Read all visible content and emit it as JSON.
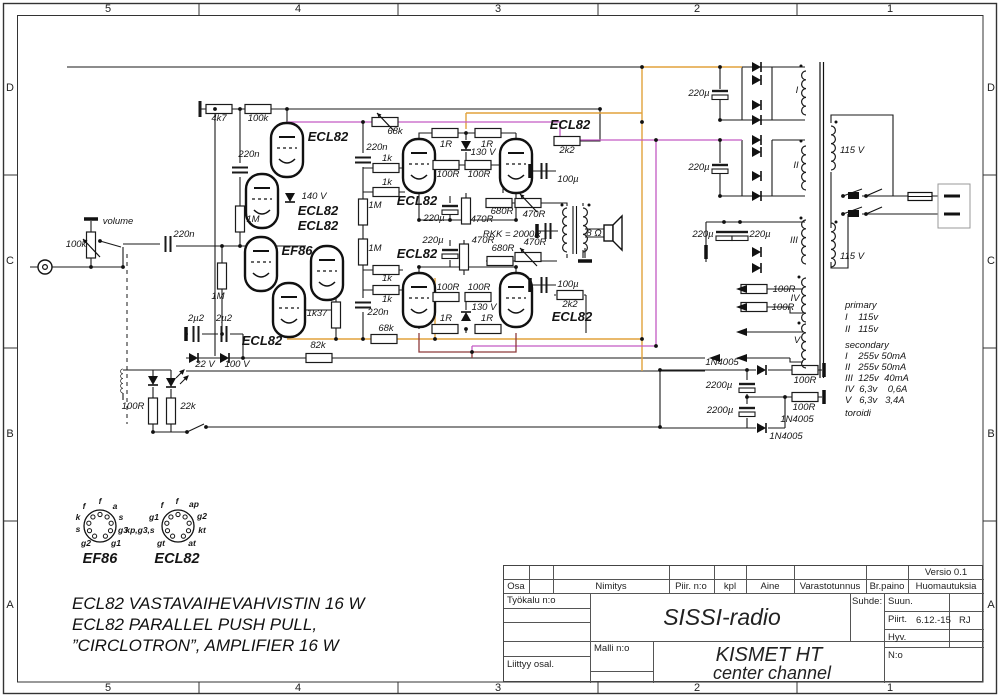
{
  "frame": {
    "cols": [
      "5",
      "4",
      "3",
      "2",
      "1"
    ],
    "rows": [
      "D",
      "C",
      "B",
      "A"
    ]
  },
  "colors": {
    "wire": "#1a1a1a",
    "orange": "#e2a23b",
    "magenta": "#c45ac4",
    "maroon": "#8e3b3b"
  },
  "notes": {
    "line1": "ECL82 VASTAVAIHEVAHVISTIN 16 W",
    "line2": "ECL82 PARALLEL PUSH PULL,",
    "line3": "”CIRCLOTRON”, AMPLIFIER 16 W"
  },
  "titleblock": {
    "versio": "Versio 0.1",
    "osa": "Osa",
    "nimitys": "Nimitys",
    "piir_no": "Piir. n:o",
    "kpl": "kpl",
    "aine": "Aine",
    "varastotunnus": "Varastotunnus",
    "brpaino": "Br.paino",
    "huomautuksia": "Huomautuksia",
    "tyokalu": "Työkalu n:o",
    "liittyy": "Liittyy osal.",
    "malli": "Malli n:o",
    "suhde": "Suhde:",
    "suun": "Suun.",
    "piirt": "Piirt.",
    "piirt_date": "6.12.-15",
    "piirt_init": "RJ",
    "hyv": "Hyv.",
    "no_label": "N:o",
    "project": "SISSI-radio",
    "title1": "KISMET HT",
    "title2": "center channel"
  },
  "schematic": {
    "labels": [
      {
        "t": "4k7",
        "x": 219,
        "y": 121
      },
      {
        "t": "100k",
        "x": 258,
        "y": 121
      },
      {
        "t": "220n",
        "x": 249,
        "y": 157
      },
      {
        "t": "1M",
        "x": 253,
        "y": 222
      },
      {
        "t": "volume",
        "x": 118,
        "y": 224
      },
      {
        "t": "100k",
        "x": 76,
        "y": 247
      },
      {
        "t": "220n",
        "x": 184,
        "y": 237
      },
      {
        "t": "1M",
        "x": 218,
        "y": 299
      },
      {
        "t": "140 V",
        "x": 314,
        "y": 199
      },
      {
        "t": "ECL82",
        "x": 328,
        "y": 141,
        "c": "b"
      },
      {
        "t": "ECL82",
        "x": 318,
        "y": 215,
        "c": "b"
      },
      {
        "t": "ECL82",
        "x": 318,
        "y": 230,
        "c": "b"
      },
      {
        "t": "EF86",
        "x": 297,
        "y": 255,
        "c": "b"
      },
      {
        "t": "ECL82",
        "x": 262,
        "y": 345,
        "c": "b"
      },
      {
        "t": "1k37",
        "x": 317,
        "y": 316
      },
      {
        "t": "82k",
        "x": 318,
        "y": 348
      },
      {
        "t": "2µ2",
        "x": 196,
        "y": 321
      },
      {
        "t": "2µ2",
        "x": 224,
        "y": 321
      },
      {
        "t": "22 V",
        "x": 205,
        "y": 367
      },
      {
        "t": "100 V",
        "x": 237,
        "y": 367
      },
      {
        "t": "100R",
        "x": 133,
        "y": 409
      },
      {
        "t": "22k",
        "x": 188,
        "y": 409
      },
      {
        "t": "68k",
        "x": 395,
        "y": 134
      },
      {
        "t": "220n",
        "x": 377,
        "y": 150
      },
      {
        "t": "1k",
        "x": 387,
        "y": 161
      },
      {
        "t": "1k",
        "x": 387,
        "y": 185
      },
      {
        "t": "1M",
        "x": 375,
        "y": 208
      },
      {
        "t": "1M",
        "x": 375,
        "y": 251
      },
      {
        "t": "1k",
        "x": 387,
        "y": 281
      },
      {
        "t": "1k",
        "x": 387,
        "y": 302
      },
      {
        "t": "220n",
        "x": 378,
        "y": 315
      },
      {
        "t": "68k",
        "x": 386,
        "y": 331
      },
      {
        "t": "1R",
        "x": 446,
        "y": 147
      },
      {
        "t": "1R",
        "x": 487,
        "y": 147
      },
      {
        "t": "130 V",
        "x": 483,
        "y": 155
      },
      {
        "t": "100R",
        "x": 448,
        "y": 177
      },
      {
        "t": "100R",
        "x": 479,
        "y": 177
      },
      {
        "t": "ECL82",
        "x": 417,
        "y": 205,
        "c": "b"
      },
      {
        "t": "ECL82",
        "x": 417,
        "y": 258,
        "c": "b"
      },
      {
        "t": "220µ",
        "x": 434,
        "y": 221
      },
      {
        "t": "470R",
        "x": 482,
        "y": 222
      },
      {
        "t": "680R",
        "x": 502,
        "y": 214
      },
      {
        "t": "470R",
        "x": 534,
        "y": 217
      },
      {
        "t": "RKK = 2000R",
        "x": 512,
        "y": 237
      },
      {
        "t": "220µ",
        "x": 433,
        "y": 243
      },
      {
        "t": "470R",
        "x": 483,
        "y": 243
      },
      {
        "t": "680R",
        "x": 503,
        "y": 251
      },
      {
        "t": "470R",
        "x": 535,
        "y": 245
      },
      {
        "t": "100R",
        "x": 448,
        "y": 290
      },
      {
        "t": "100R",
        "x": 479,
        "y": 290
      },
      {
        "t": "130 V",
        "x": 484,
        "y": 310
      },
      {
        "t": "1R",
        "x": 446,
        "y": 321
      },
      {
        "t": "1R",
        "x": 487,
        "y": 321
      },
      {
        "t": "2k2",
        "x": 567,
        "y": 153
      },
      {
        "t": "ECL82",
        "x": 570,
        "y": 129,
        "c": "b"
      },
      {
        "t": "100µ",
        "x": 568,
        "y": 182
      },
      {
        "t": "8 Ω",
        "x": 594,
        "y": 236
      },
      {
        "t": "100µ",
        "x": 568,
        "y": 287
      },
      {
        "t": "2k2",
        "x": 570,
        "y": 307
      },
      {
        "t": "ECL82",
        "x": 572,
        "y": 321,
        "c": "b"
      },
      {
        "t": "220µ",
        "x": 699,
        "y": 96
      },
      {
        "t": "220µ",
        "x": 699,
        "y": 170
      },
      {
        "t": "I",
        "x": 797,
        "y": 93
      },
      {
        "t": "II",
        "x": 796,
        "y": 168
      },
      {
        "t": "III",
        "x": 794,
        "y": 243
      },
      {
        "t": "IV",
        "x": 795,
        "y": 301
      },
      {
        "t": "V",
        "x": 797,
        "y": 343
      },
      {
        "t": "115 V",
        "x": 852,
        "y": 153
      },
      {
        "t": "115 V",
        "x": 852,
        "y": 259
      },
      {
        "t": "220µ",
        "x": 703,
        "y": 237
      },
      {
        "t": "220µ",
        "x": 760,
        "y": 237
      },
      {
        "t": "100R",
        "x": 784,
        "y": 292
      },
      {
        "t": "100R",
        "x": 783,
        "y": 310
      },
      {
        "t": "1N4005",
        "x": 722,
        "y": 365
      },
      {
        "t": "2200µ",
        "x": 719,
        "y": 388
      },
      {
        "t": "2200µ",
        "x": 720,
        "y": 413
      },
      {
        "t": "100R",
        "x": 805,
        "y": 383
      },
      {
        "t": "100R",
        "x": 804,
        "y": 410
      },
      {
        "t": "1N4005",
        "x": 797,
        "y": 422
      },
      {
        "t": "1N4005",
        "x": 786,
        "y": 439
      },
      {
        "t": "primary",
        "x": 845,
        "y": 308,
        "c": "sp",
        "a": "s"
      },
      {
        "t": "I    115v",
        "x": 845,
        "y": 320,
        "c": "sp",
        "a": "s"
      },
      {
        "t": "II   115v",
        "x": 845,
        "y": 332,
        "c": "sp",
        "a": "s"
      },
      {
        "t": "secondary",
        "x": 845,
        "y": 348,
        "c": "sp",
        "a": "s"
      },
      {
        "t": "I    255v 50mA",
        "x": 845,
        "y": 359,
        "c": "sp",
        "a": "s"
      },
      {
        "t": "II   255v 50mA",
        "x": 845,
        "y": 370,
        "c": "sp",
        "a": "s"
      },
      {
        "t": "III  125v  40mA",
        "x": 845,
        "y": 381,
        "c": "sp",
        "a": "s"
      },
      {
        "t": "IV  6,3v    0,6A",
        "x": 845,
        "y": 392,
        "c": "sp",
        "a": "s"
      },
      {
        "t": "V   6,3v   3,4A",
        "x": 845,
        "y": 403,
        "c": "sp",
        "a": "s"
      },
      {
        "t": "toroidi",
        "x": 845,
        "y": 416,
        "c": "sp",
        "a": "s"
      },
      {
        "t": "f",
        "x": 100,
        "y": 504,
        "c": "pin"
      },
      {
        "t": "f",
        "x": 84,
        "y": 509,
        "c": "pin"
      },
      {
        "t": "a",
        "x": 115,
        "y": 509,
        "c": "pin"
      },
      {
        "t": "k",
        "x": 78,
        "y": 520,
        "c": "pin"
      },
      {
        "t": "s",
        "x": 121,
        "y": 520,
        "c": "pin"
      },
      {
        "t": "s",
        "x": 78,
        "y": 532,
        "c": "pin"
      },
      {
        "t": "g3",
        "x": 123,
        "y": 533,
        "c": "pin"
      },
      {
        "t": "g2",
        "x": 86,
        "y": 546,
        "c": "pin"
      },
      {
        "t": "g1",
        "x": 116,
        "y": 546,
        "c": "pin"
      },
      {
        "t": "EF86",
        "x": 100,
        "y": 563,
        "c": "pname"
      },
      {
        "t": "f",
        "x": 177,
        "y": 504,
        "c": "pin"
      },
      {
        "t": "f",
        "x": 162,
        "y": 508,
        "c": "pin"
      },
      {
        "t": "ap",
        "x": 194,
        "y": 507,
        "c": "pin"
      },
      {
        "t": "g1",
        "x": 154,
        "y": 520,
        "c": "pin"
      },
      {
        "t": "g2",
        "x": 202,
        "y": 519,
        "c": "pin"
      },
      {
        "t": "kp,g3,s",
        "x": 140,
        "y": 533,
        "c": "pin"
      },
      {
        "t": "kt",
        "x": 202,
        "y": 533,
        "c": "pin"
      },
      {
        "t": "gt",
        "x": 161,
        "y": 546,
        "c": "pin"
      },
      {
        "t": "at",
        "x": 192,
        "y": 546,
        "c": "pin"
      },
      {
        "t": "ECL82",
        "x": 177,
        "y": 563,
        "c": "pname"
      }
    ]
  }
}
